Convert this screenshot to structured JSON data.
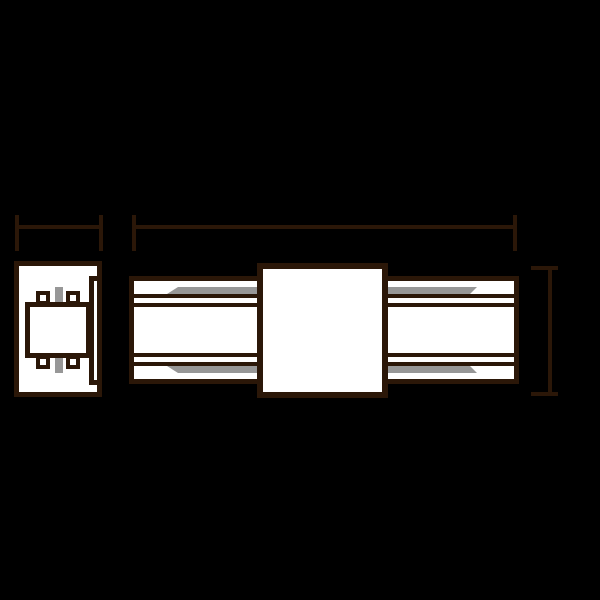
{
  "colors": {
    "background": "#000000",
    "outline": "#2b1708",
    "fill": "#ffffff",
    "accent": "#979797"
  },
  "drawing": {
    "kind": "technical-dimension-drawing",
    "views": {
      "end_view": "connector end profile",
      "side_view": "connector side profile with center coupler block"
    },
    "dimension_markers": [
      "width",
      "length",
      "height"
    ]
  }
}
